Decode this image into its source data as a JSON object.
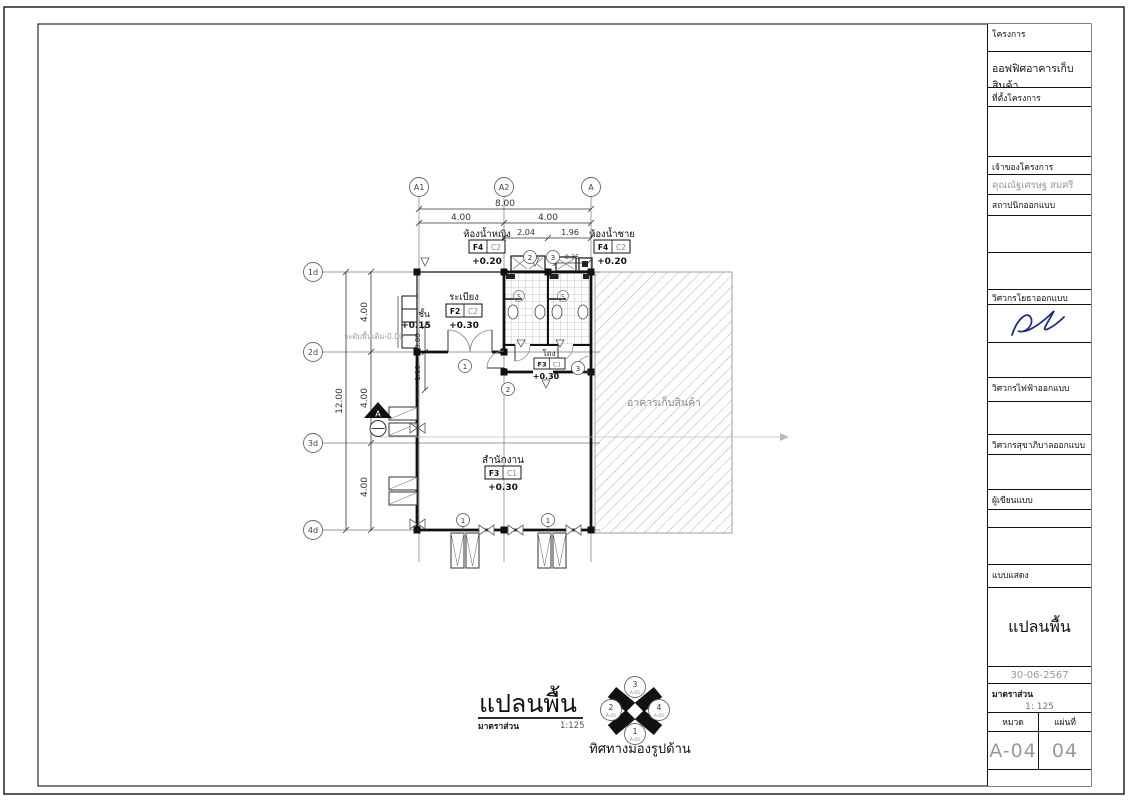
{
  "colors": {
    "line": "#111111",
    "muted_gray": "#999999",
    "dim_gray": "#444444",
    "signature_ink": "#22307e",
    "hatch_gray": "#aaaaaa"
  },
  "title_block": {
    "project_label": "โครงการ",
    "project_name": "ออฟฟิศอาคารเก็บสินค้า",
    "site_label": "ที่ตั้งโครงการ",
    "owner_label": "เจ้าของโครงการ",
    "owner_name": "คุณณัฐเศรษฐ สมศรี",
    "architect_label": "สถาปนิกออกแบบ",
    "civil_engineer_label": "วิศวกรโยธาออกแบบ",
    "electrical_engineer_label": "วิศวกรไฟฟ้าออกแบบ",
    "sanitary_engineer_label": "วิศวกรสุขาภิบาลออกแบบ",
    "draftsman_label": "ผู้เขียนแบบ",
    "drawing_shows_label": "แบบแสดง",
    "drawing_title": "แปลนพื้น",
    "date": "30-06-2567",
    "scale_label": "มาตราส่วน",
    "scale_value": "1: 125",
    "category_label": "หมวด",
    "sheet_label": "แผ่นที่",
    "drawing_number": "A-04",
    "sheet_number": "04"
  },
  "plan": {
    "grid": {
      "cols": [
        "A1",
        "A2",
        "A"
      ],
      "rows": [
        "1d",
        "2d",
        "3d",
        "4d"
      ]
    },
    "dims": {
      "total_width": "8.00",
      "bay_left": "4.00",
      "bay_right": "4.00",
      "sub_left": "2.04",
      "sub_right": "1.96",
      "sub_small": "0.35",
      "total_height": "12.00",
      "row1": "4.00",
      "row2": "4.00",
      "row3": "4.00",
      "d_080": "0.80",
      "d_110": "1.10"
    },
    "rooms": {
      "terrace": {
        "name": "ระเบียง",
        "floor_tag": "F2",
        "ceiling_tag": "C2",
        "level": "+0.30"
      },
      "toilet_women": {
        "name": "ห้องน้ำหญิง",
        "floor_tag": "F4",
        "ceiling_tag": "C2",
        "level": "+0.20"
      },
      "toilet_men": {
        "name": "ห้องน้ำชาย",
        "floor_tag": "F4",
        "ceiling_tag": "C2",
        "level": "+0.20"
      },
      "hall": {
        "name": "โถง",
        "floor_tag": "F3",
        "ceiling_tag": "C1",
        "level": "+0.30"
      },
      "office": {
        "name": "สำนักงาน",
        "floor_tag": "F3",
        "ceiling_tag": "C1",
        "level": "+0.30"
      },
      "warehouse": {
        "name": "อาคารเก็บสินค้า"
      }
    },
    "annotations": {
      "step": "ชั้น",
      "step_level": "+0.15",
      "existing_ground": "ระดับพื้นเดิม-0.00",
      "section_mark": "A"
    },
    "tags": {
      "door1": "1",
      "door2": "2",
      "door3": "3",
      "window1": "1",
      "fixture5": "5"
    }
  },
  "footer": {
    "title": "แปลนพื้น",
    "scale_label": "มาตราส่วน",
    "scale_value": "1:125",
    "compass_caption": "ทิศทางมองรูปด้าน",
    "compass": {
      "top": {
        "n": "3",
        "ref": "A-05"
      },
      "bottom": {
        "n": "1",
        "ref": "A-05"
      },
      "left": {
        "n": "2",
        "ref": "A-05"
      },
      "right": {
        "n": "4",
        "ref": "A-05"
      }
    }
  }
}
